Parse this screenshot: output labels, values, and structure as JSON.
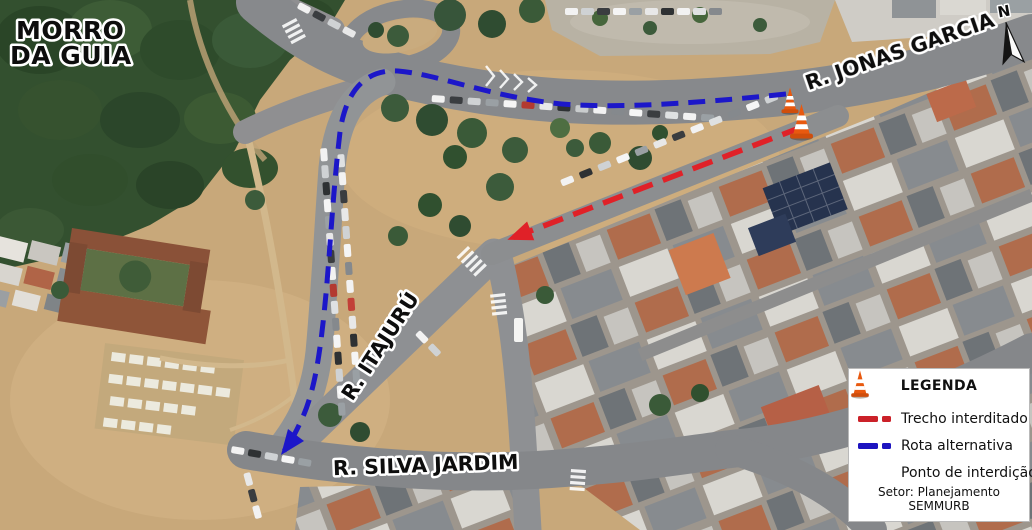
{
  "map": {
    "area_label": {
      "line1": "MORRO",
      "line2": "DA GUIA"
    },
    "streets": {
      "jonas_garcia": "R. JONAS GARCIA",
      "itajuru": "R. ITAJURÚ",
      "silva_jardim": "R. SILVA JARDIM"
    },
    "north_indicator": "N"
  },
  "routes": {
    "closed_segment_color": "#e02128",
    "alternative_route_color": "#1c17c9"
  },
  "legend": {
    "title": "LEGENDA",
    "items": [
      {
        "icon": "red-dashed-line",
        "label": "Trecho interditado",
        "color": "#cb2129"
      },
      {
        "icon": "blue-dashed-line",
        "label": "Rota alternativa",
        "color": "#1d14c0"
      },
      {
        "icon": "traffic-cone-icon",
        "label": "Ponto de interdição",
        "color": "#e8590f"
      }
    ],
    "footer": "Setor: Planejamento SEMMURB"
  }
}
